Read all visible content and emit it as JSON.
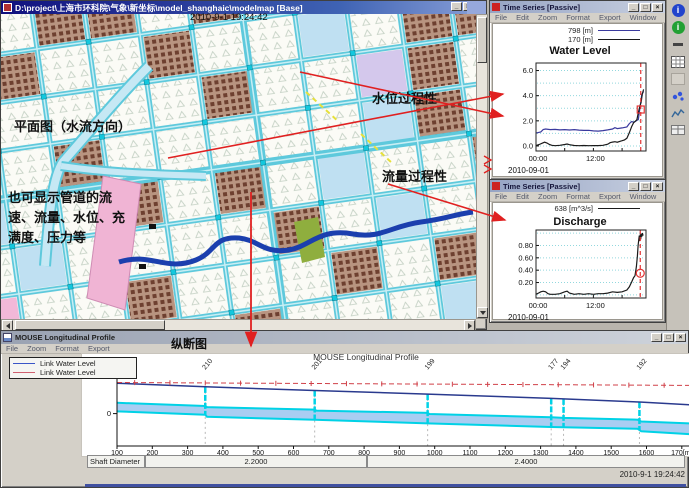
{
  "window_controls": {
    "minimize": "_",
    "maximize": "□",
    "close": "×"
  },
  "map_window": {
    "title": "D:\\project\\上海市环科院\\气象\\新坐标\\model_shanghaic\\modelmap [Base]",
    "datetime": "2010-9-1 19:24:42",
    "annotations": {
      "plan": "平面图（水流方向）",
      "note": "也可显示管道的流速、流量、水位、充满度、压力等",
      "water_level": "水位过程性",
      "discharge": "流量过程性"
    }
  },
  "water_level_window": {
    "title": "Time Series [Passive]",
    "menus": [
      "File",
      "Edit",
      "Zoom",
      "Format",
      "Export",
      "Window"
    ]
  },
  "discharge_window": {
    "title": "Time Series [Passive]",
    "menus": [
      "File",
      "Edit",
      "Zoom",
      "Format",
      "Export",
      "Window"
    ]
  },
  "profile_window": {
    "title": "MOUSE Longitudinal Profile",
    "menus": [
      "File",
      "Zoom",
      "Format",
      "Export"
    ],
    "annotation": "纵断图"
  },
  "toolbar": {
    "icons": [
      "info-icon",
      "ok-icon",
      "separator-icon",
      "report-icon",
      "blank-icon",
      "scatter-icon",
      "chart-icon",
      "table-icon"
    ]
  },
  "chart_data": [
    {
      "id": "water_level",
      "type": "line",
      "title": "Water Level",
      "date": "2010-09-01",
      "xlim": [
        0,
        23
      ],
      "ylim": [
        -0.4,
        6.6
      ],
      "grid": {
        "step": 1,
        "count": 7
      },
      "yticks": [
        {
          "v": 0,
          "label": "0.0"
        },
        {
          "v": 2,
          "label": "2.0"
        },
        {
          "v": 4,
          "label": "4.0"
        },
        {
          "v": 6,
          "label": "6.0"
        }
      ],
      "xticks": [
        {
          "v": 0,
          "label": "00:00"
        },
        {
          "v": 12,
          "label": "12:00"
        }
      ],
      "xticks_minor": [
        0,
        6,
        12,
        18
      ],
      "cursor_x": 21.9,
      "marker": {
        "x": 21.9,
        "y": 2.9,
        "shape": "square"
      },
      "series": [
        {
          "name": "798 [m]",
          "color": "#3a3a9e",
          "points": [
            [
              0,
              1.02
            ],
            [
              1,
              1.12
            ],
            [
              1.5,
              1.3
            ],
            [
              2,
              1.35
            ],
            [
              3,
              1.3
            ],
            [
              4,
              1.32
            ],
            [
              5,
              1.28
            ],
            [
              6,
              1.3
            ],
            [
              7,
              1.27
            ],
            [
              8,
              1.3
            ],
            [
              9,
              1.26
            ],
            [
              10,
              1.24
            ],
            [
              11,
              1.25
            ],
            [
              12,
              1.2
            ],
            [
              13,
              1.18
            ],
            [
              14,
              1.22
            ],
            [
              15,
              1.28
            ],
            [
              16,
              1.35
            ],
            [
              16.5,
              1.45
            ],
            [
              17,
              1.38
            ],
            [
              18,
              1.44
            ],
            [
              19,
              1.52
            ],
            [
              19.5,
              1.78
            ],
            [
              20,
              1.95
            ],
            [
              20.5,
              1.88
            ],
            [
              21,
              2.02
            ],
            [
              21.4,
              2.1
            ],
            [
              21.8,
              3.2
            ],
            [
              22.1,
              4.05
            ],
            [
              22.5,
              4.35
            ]
          ]
        },
        {
          "name": "170 [m]",
          "color": "#1a1a1a",
          "points": [
            [
              0,
              0.03
            ],
            [
              0.7,
              0.12
            ],
            [
              1.3,
              0.22
            ],
            [
              1.8,
              0.3
            ],
            [
              2.3,
              0.24
            ],
            [
              2.8,
              0.12
            ],
            [
              3.3,
              0.05
            ],
            [
              4,
              0.02
            ],
            [
              5,
              0.05
            ],
            [
              6,
              0.12
            ],
            [
              6.5,
              0.16
            ],
            [
              7,
              0.1
            ],
            [
              8,
              0.04
            ],
            [
              9,
              0.02
            ],
            [
              10,
              0.04
            ],
            [
              11,
              0.02
            ],
            [
              12,
              0.03
            ],
            [
              13,
              0.03
            ],
            [
              14,
              0.05
            ],
            [
              15,
              0.14
            ],
            [
              15.5,
              0.26
            ],
            [
              16,
              0.31
            ],
            [
              16.5,
              0.34
            ],
            [
              17,
              0.3
            ],
            [
              17.5,
              0.36
            ],
            [
              18,
              0.42
            ],
            [
              18.5,
              0.48
            ],
            [
              19,
              0.62
            ],
            [
              19.5,
              1.05
            ],
            [
              20,
              1.55
            ],
            [
              20.4,
              1.85
            ],
            [
              20.8,
              1.98
            ],
            [
              21.1,
              2.1
            ],
            [
              21.4,
              2.65
            ],
            [
              21.7,
              3.15
            ],
            [
              22,
              3.5
            ],
            [
              22.2,
              4.1
            ],
            [
              22.5,
              4.5
            ]
          ]
        }
      ]
    },
    {
      "id": "discharge",
      "type": "line",
      "title": "Discharge",
      "date": "2010-09-01",
      "xlim": [
        0,
        23
      ],
      "ylim": [
        -0.05,
        1.05
      ],
      "grid": {
        "step": 0.2,
        "count": 6
      },
      "yticks": [
        {
          "v": 0.2,
          "label": "0.20"
        },
        {
          "v": 0.4,
          "label": "0.40"
        },
        {
          "v": 0.6,
          "label": "0.60"
        },
        {
          "v": 0.8,
          "label": "0.80"
        }
      ],
      "xticks": [
        {
          "v": 0,
          "label": "00:00"
        },
        {
          "v": 12,
          "label": "12:00"
        }
      ],
      "xticks_minor": [
        0,
        6,
        12,
        18
      ],
      "cursor_x": 21.8,
      "marker": {
        "x": 21.8,
        "y": 0.35,
        "shape": "circle"
      },
      "series": [
        {
          "name": "638 [m^3/s]",
          "color": "#1a1a1a",
          "points": [
            [
              0,
              0.01
            ],
            [
              0.5,
              0.03
            ],
            [
              1,
              0.05
            ],
            [
              1.5,
              0.06
            ],
            [
              2,
              0.05
            ],
            [
              2.5,
              0.02
            ],
            [
              3,
              0.01
            ],
            [
              4,
              0.01
            ],
            [
              5,
              0.02
            ],
            [
              6,
              0.05
            ],
            [
              6.5,
              0.06
            ],
            [
              7,
              0.03
            ],
            [
              8,
              0.01
            ],
            [
              9,
              0.02
            ],
            [
              10,
              0.01
            ],
            [
              11,
              0.02
            ],
            [
              12,
              0.01
            ],
            [
              13,
              0.02
            ],
            [
              14,
              0.02
            ],
            [
              15,
              0.03
            ],
            [
              16,
              0.05
            ],
            [
              17,
              0.04
            ],
            [
              18,
              0.05
            ],
            [
              19,
              0.08
            ],
            [
              19.5,
              0.13
            ],
            [
              20,
              0.21
            ],
            [
              20.4,
              0.28
            ],
            [
              20.7,
              0.31
            ],
            [
              21,
              0.46
            ],
            [
              21.2,
              0.63
            ],
            [
              21.35,
              0.8
            ],
            [
              21.5,
              0.9
            ],
            [
              21.6,
              0.96
            ],
            [
              21.7,
              0.87
            ],
            [
              21.8,
              0.98
            ],
            [
              21.9,
              0.9
            ],
            [
              22,
              0.99
            ],
            [
              22.1,
              0.94
            ],
            [
              22.25,
              1.0
            ],
            [
              22.4,
              0.96
            ]
          ]
        }
      ]
    },
    {
      "id": "profile",
      "type": "area-profile",
      "title": "MOUSE Longitudinal Profile",
      "ylabel": "[m]",
      "y_zero_label": "0",
      "legend": [
        {
          "label": "Link Water Level",
          "color": "#3a55c8"
        },
        {
          "label": "Link Water Level",
          "color": "#d06070"
        }
      ],
      "x_range_m": [
        100,
        1725
      ],
      "x_ticks": [
        {
          "m": 100,
          "label": "100"
        },
        {
          "m": 200,
          "label": "200"
        },
        {
          "m": 300,
          "label": "300"
        },
        {
          "m": 400,
          "label": "400"
        },
        {
          "m": 500,
          "label": "500"
        },
        {
          "m": 600,
          "label": "600"
        },
        {
          "m": 700,
          "label": "700"
        },
        {
          "m": 800,
          "label": "800"
        },
        {
          "m": 900,
          "label": "900"
        },
        {
          "m": 1000,
          "label": "1000"
        },
        {
          "m": 1100,
          "label": "1100"
        },
        {
          "m": 1200,
          "label": "1200"
        },
        {
          "m": 1300,
          "label": "1300"
        },
        {
          "m": 1400,
          "label": "1400"
        },
        {
          "m": 1500,
          "label": "1500"
        },
        {
          "m": 1600,
          "label": "1600"
        },
        {
          "m": 1700,
          "label": "170[m]"
        }
      ],
      "nodes": [
        {
          "label": "210",
          "m": 350
        },
        {
          "label": "201",
          "m": 660
        },
        {
          "label": "199",
          "m": 980
        },
        {
          "label": "177",
          "m": 1330
        },
        {
          "label": "194",
          "m": 1365
        },
        {
          "label": "192",
          "m": 1580
        }
      ],
      "max_water_level": [
        [
          100,
          4.3
        ],
        [
          1725,
          3.9
        ]
      ],
      "ground_line": [
        [
          100,
          4.2
        ],
        [
          350,
          3.7
        ],
        [
          660,
          3.2
        ],
        [
          980,
          2.7
        ],
        [
          1330,
          2.1
        ],
        [
          1580,
          1.6
        ],
        [
          1725,
          1.2
        ]
      ],
      "water_surface": [
        [
          100,
          1.5
        ],
        [
          350,
          1.05
        ],
        [
          355,
          0.9
        ],
        [
          660,
          0.55
        ],
        [
          665,
          0.42
        ],
        [
          980,
          0.1
        ],
        [
          985,
          -0.05
        ],
        [
          1330,
          -0.5
        ],
        [
          1365,
          -0.6
        ],
        [
          1575,
          -0.85
        ],
        [
          1585,
          -1.1
        ],
        [
          1725,
          -1.35
        ]
      ],
      "invert_level": [
        [
          100,
          0.3
        ],
        [
          350,
          -0.15
        ],
        [
          355,
          -0.45
        ],
        [
          660,
          -0.85
        ],
        [
          980,
          -1.35
        ],
        [
          1330,
          -1.85
        ],
        [
          1575,
          -2.1
        ],
        [
          1585,
          -2.45
        ],
        [
          1725,
          -2.85
        ]
      ],
      "shaft_diameter": {
        "label": "Shaft Diameter",
        "segments": [
          {
            "value": "2.2000"
          },
          {
            "value": "2.4000"
          }
        ]
      },
      "timestamp": "2010-9-1 19:24:42"
    }
  ]
}
